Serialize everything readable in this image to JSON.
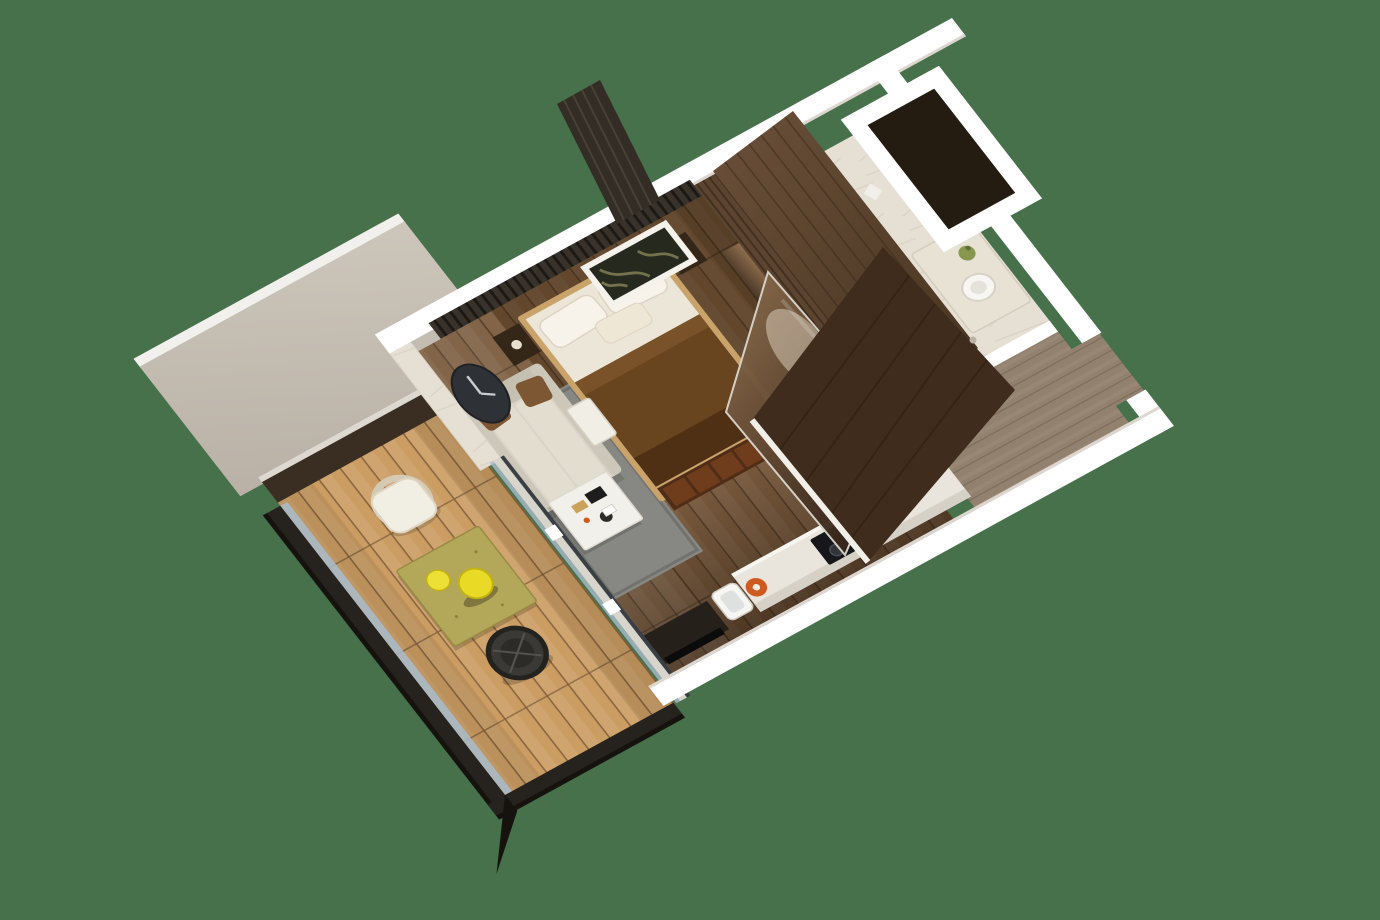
{
  "scene": {
    "description": "3D top-down isometric render of a studio apartment floor plan on a plain green background",
    "view": "rotated-top-down-perspective",
    "rotation_deg": 28
  },
  "palette": {
    "background": "#47714b",
    "wall": "#ffffff",
    "wall_shade": "#ddd7cf",
    "awning": "#b9b1a6",
    "awning_light": "#cdc6bb",
    "awning_edge": "#f2f0ec",
    "deck": "#cb9d63",
    "deck_seam": "#8a6540",
    "railing": "#26231e",
    "railing_dark": "#16130f",
    "glass": "#a9bccd",
    "frame_dark": "#3a3f45",
    "marble": "#e6e0d4",
    "marble_vein": "#cfc7b8",
    "shaft": "#241b11",
    "hall_floor": "#93816f",
    "hall_seam": "#7d6c5b",
    "floor": "#7b5c3e",
    "floor_seam": "#57402a",
    "wood_wall": "#5d4431",
    "wood_wall_dark": "#42301f",
    "slat": "#38322a",
    "slat_gap": "#1d1915",
    "mirror_light": "#8f6f4e",
    "mirror_dark": "#241710",
    "door": "#3f2c1c",
    "door_grain": "#2e1f13",
    "mattress": "#ece6d9",
    "pillow": "#f7f3ea",
    "blanket": "#68441f",
    "blanket_dark": "#4f3014",
    "bench": "#4f2d16",
    "bench_cushion": "#6f3c1c",
    "frame_wood": "#caa36b",
    "nightstand": "#342718",
    "sofa": "#d9d4c8",
    "sofa_back": "#c6c0b2",
    "sofa_cushion": "#e3ddd0",
    "sofa_pillow": "#7d5634",
    "rug": "#878883",
    "rug_border": "#6f706b",
    "table_white": "#f2f0ea",
    "tv": "#26201a",
    "tv_screen": "#0b0b0b",
    "counter": "#e9e5dc",
    "cooktop": "#17171b",
    "kettle": "#cf5a20",
    "fixture_white": "#f7f6f3",
    "fixture_stroke": "#d8d2c6",
    "plant": "#87974f",
    "clock": "#2e3237",
    "clock_hand": "#c9cdd2",
    "artwork_bg": "#262a1e",
    "artwork_leaf": "#7d7a52",
    "balcony_table": "#b3a75a",
    "lemon": "#e8da25",
    "chair_white": "#f1eee3",
    "chair_dark": "#3a3936"
  },
  "rooms": [
    {
      "id": "bedroom",
      "furniture": [
        "double-bed",
        "pillows",
        "blanket",
        "foot-bench",
        "nightstand-left",
        "nightstand-right",
        "wall-artwork",
        "slat-wall"
      ]
    },
    {
      "id": "living-area",
      "furniture": [
        "sofa",
        "sofa-pillows",
        "side-table",
        "coffee-table",
        "rug",
        "tv-console",
        "wall-clock",
        "marble-feature-wall"
      ]
    },
    {
      "id": "kitchenette",
      "furniture": [
        "counter",
        "cooktop",
        "sink",
        "kettle",
        "tall-cabinet"
      ]
    },
    {
      "id": "bathroom",
      "furniture": [
        "shower-zone",
        "toilet",
        "vanity-counter",
        "vessel-sink",
        "plant"
      ]
    },
    {
      "id": "entry-hall",
      "furniture": [
        "open-entry-door",
        "wardrobe-mirror"
      ]
    },
    {
      "id": "balcony",
      "furniture": [
        "outdoor-table",
        "decor-balls",
        "rattan-chair",
        "woven-chair",
        "glass-railing",
        "deck"
      ]
    },
    {
      "id": "technical-shaft",
      "furniture": []
    }
  ]
}
